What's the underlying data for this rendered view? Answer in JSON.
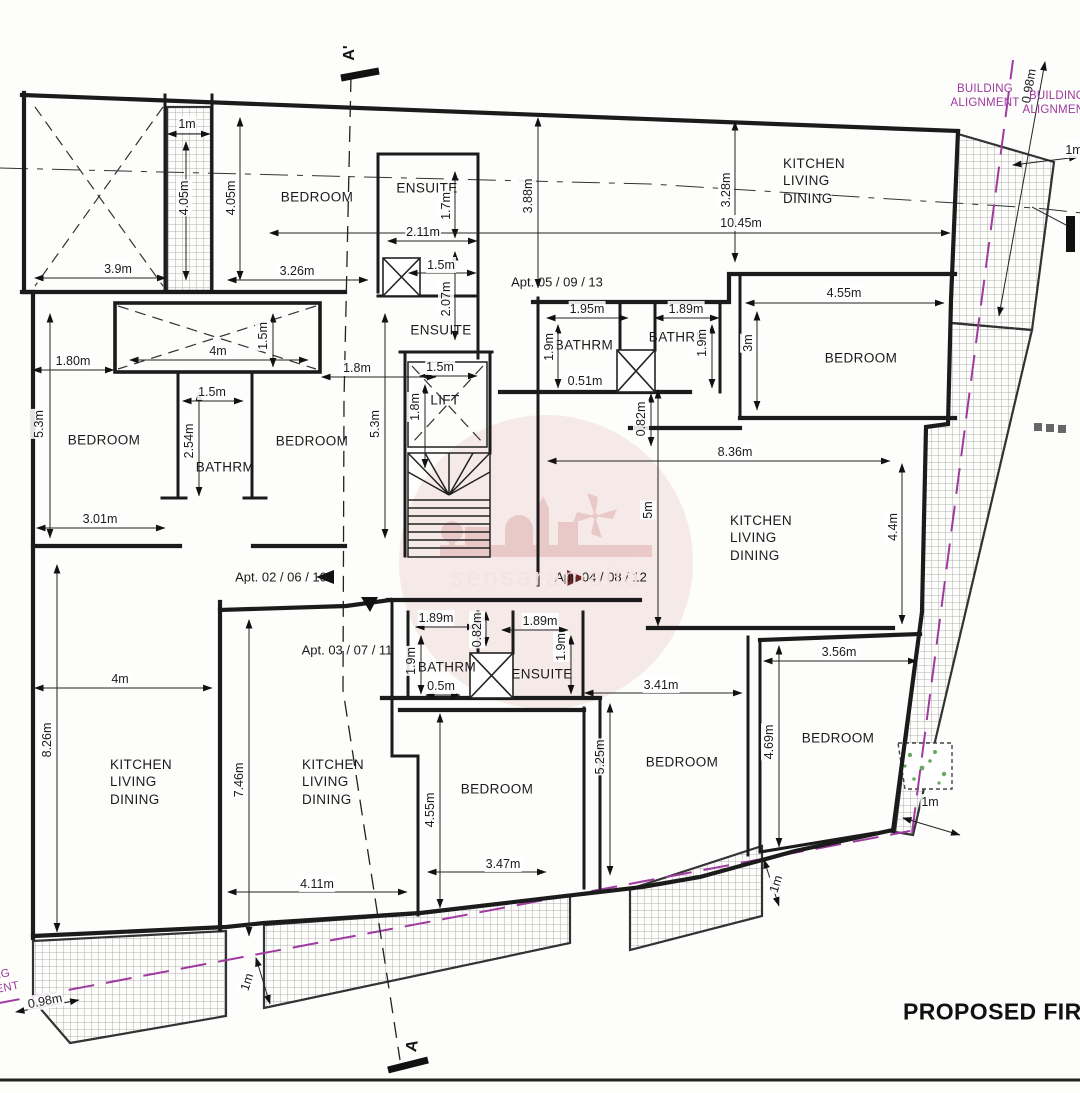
{
  "drawing_title": "PROPOSED FIRST",
  "watermark_text": "sensaramalta",
  "section": {
    "top": "A'",
    "bottom": "A"
  },
  "colors": {
    "wall": "#1b1b1b",
    "alignment_purple": "#9c3a9c",
    "watermark_pink": "#dca0a0",
    "planting_green": "#4a9a4a"
  },
  "rooms": [
    {
      "text": "BEDROOM",
      "x": 317,
      "y": 197
    },
    {
      "text": "ENSUITE",
      "x": 427,
      "y": 188
    },
    {
      "text": "ENSUITE",
      "x": 441,
      "y": 330
    },
    {
      "text": "LIFT",
      "x": 445,
      "y": 400
    },
    {
      "text": "BATHRM",
      "x": 584,
      "y": 345
    },
    {
      "text": "BATHRM",
      "x": 678,
      "y": 337
    },
    {
      "text": "BEDROOM",
      "x": 861,
      "y": 358
    },
    {
      "text": "KITCHEN\nLIVING\nDINING",
      "x": 783,
      "y": 181,
      "anchor": "l"
    },
    {
      "text": "BEDROOM",
      "x": 104,
      "y": 440
    },
    {
      "text": "BATHRM",
      "x": 225,
      "y": 467
    },
    {
      "text": "BEDROOM",
      "x": 312,
      "y": 441
    },
    {
      "text": "KITCHEN\nLIVING\nDINING",
      "x": 730,
      "y": 538,
      "anchor": "l"
    },
    {
      "text": "KITCHEN\nLIVING\nDINING",
      "x": 110,
      "y": 782,
      "anchor": "l"
    },
    {
      "text": "KITCHEN\nLIVING\nDINING",
      "x": 302,
      "y": 782,
      "anchor": "l"
    },
    {
      "text": "BATHRM",
      "x": 447,
      "y": 667
    },
    {
      "text": "ENSUITE",
      "x": 542,
      "y": 674
    },
    {
      "text": "BEDROOM",
      "x": 497,
      "y": 789
    },
    {
      "text": "BEDROOM",
      "x": 682,
      "y": 762
    },
    {
      "text": "BEDROOM",
      "x": 838,
      "y": 738
    }
  ],
  "apartments": [
    {
      "text": "Apt. 05 / 09 / 13",
      "x": 557,
      "y": 283
    },
    {
      "text": "Apt. 02 / 06 / 10",
      "x": 281,
      "y": 578
    },
    {
      "text": "Apt. 03 / 07 / 11",
      "x": 347,
      "y": 651
    },
    {
      "text": "Apt. 04 / 08 / 12",
      "x": 601,
      "y": 578
    }
  ],
  "alignment_notes": [
    {
      "text": "BUILDING\nALIGNMENT",
      "x": 985,
      "y": 97
    },
    {
      "text": "BUILDING\nALIGNMENT",
      "x": 1057,
      "y": 104
    },
    {
      "text": "BUILDING\nALIGNMENT",
      "x": -16,
      "y": 986,
      "rot": -11
    }
  ],
  "dimensions": [
    {
      "text": "1m",
      "x": 187,
      "y": 124
    },
    {
      "text": "4.05m",
      "x": 184,
      "y": 198,
      "rot": -90
    },
    {
      "text": "4.05m",
      "x": 231,
      "y": 198,
      "rot": -90
    },
    {
      "text": "3.9m",
      "x": 118,
      "y": 269
    },
    {
      "text": "3.26m",
      "x": 297,
      "y": 271
    },
    {
      "text": "2.11m",
      "x": 423,
      "y": 232
    },
    {
      "text": "1.7m",
      "x": 446,
      "y": 206,
      "rot": -90
    },
    {
      "text": "1.5m",
      "x": 441,
      "y": 265
    },
    {
      "text": "2.07m",
      "x": 446,
      "y": 299,
      "rot": -90
    },
    {
      "text": "3.88m",
      "x": 528,
      "y": 196,
      "rot": -90
    },
    {
      "text": "10.45m",
      "x": 741,
      "y": 223
    },
    {
      "text": "3.28m",
      "x": 726,
      "y": 190,
      "rot": -90
    },
    {
      "text": "1.5m",
      "x": 440,
      "y": 367
    },
    {
      "text": "1.8m",
      "x": 415,
      "y": 407,
      "rot": -90
    },
    {
      "text": "1.80m",
      "x": 73,
      "y": 361
    },
    {
      "text": "4m",
      "x": 218,
      "y": 351
    },
    {
      "text": "1.5m",
      "x": 263,
      "y": 336,
      "rot": -90
    },
    {
      "text": "1.8m",
      "x": 357,
      "y": 368
    },
    {
      "text": "5.3m",
      "x": 39,
      "y": 424,
      "rot": -90
    },
    {
      "text": "5.3m",
      "x": 375,
      "y": 424,
      "rot": -90
    },
    {
      "text": "1.5m",
      "x": 212,
      "y": 392
    },
    {
      "text": "2.54m",
      "x": 189,
      "y": 441,
      "rot": -90
    },
    {
      "text": "3.01m",
      "x": 100,
      "y": 519
    },
    {
      "text": "1.95m",
      "x": 587,
      "y": 309
    },
    {
      "text": "1.9m",
      "x": 549,
      "y": 347,
      "rot": -90
    },
    {
      "text": "0.51m",
      "x": 585,
      "y": 381
    },
    {
      "text": "1.89m",
      "x": 686,
      "y": 309
    },
    {
      "text": "1.9m",
      "x": 702,
      "y": 343,
      "rot": -90
    },
    {
      "text": "0.82m",
      "x": 641,
      "y": 419,
      "rot": -90
    },
    {
      "text": "4.55m",
      "x": 844,
      "y": 293
    },
    {
      "text": "3m",
      "x": 748,
      "y": 343,
      "rot": -90
    },
    {
      "text": "8.36m",
      "x": 735,
      "y": 452
    },
    {
      "text": "5m",
      "x": 648,
      "y": 510,
      "rot": -90
    },
    {
      "text": "4.4m",
      "x": 893,
      "y": 527,
      "rot": -90
    },
    {
      "text": "1.89m",
      "x": 436,
      "y": 618
    },
    {
      "text": "0.82m",
      "x": 477,
      "y": 630,
      "rot": -90
    },
    {
      "text": "1.89m",
      "x": 540,
      "y": 621
    },
    {
      "text": "1.9m",
      "x": 411,
      "y": 661,
      "rot": -90
    },
    {
      "text": "0.5m",
      "x": 441,
      "y": 686
    },
    {
      "text": "1.9m",
      "x": 561,
      "y": 647,
      "rot": -90
    },
    {
      "text": "3.41m",
      "x": 661,
      "y": 685
    },
    {
      "text": "5.25m",
      "x": 600,
      "y": 757,
      "rot": -90
    },
    {
      "text": "4.55m",
      "x": 430,
      "y": 810,
      "rot": -90
    },
    {
      "text": "3.47m",
      "x": 503,
      "y": 864
    },
    {
      "text": "7.46m",
      "x": 239,
      "y": 780,
      "rot": -90
    },
    {
      "text": "4m",
      "x": 120,
      "y": 679
    },
    {
      "text": "8.26m",
      "x": 47,
      "y": 740,
      "rot": -90
    },
    {
      "text": "4.11m",
      "x": 317,
      "y": 884
    },
    {
      "text": "3.56m",
      "x": 839,
      "y": 652
    },
    {
      "text": "4.69m",
      "x": 769,
      "y": 742,
      "rot": -90
    },
    {
      "text": "1m",
      "x": 930,
      "y": 802
    },
    {
      "text": "1m",
      "x": 776,
      "y": 884,
      "rot": -72
    },
    {
      "text": "1m",
      "x": 247,
      "y": 982,
      "rot": -72
    },
    {
      "text": "0.98m",
      "x": 45,
      "y": 1001,
      "rot": -11
    },
    {
      "text": "0.98m",
      "x": 1029,
      "y": 86,
      "rot": -80
    },
    {
      "text": "1m",
      "x": 1074,
      "y": 150
    }
  ]
}
